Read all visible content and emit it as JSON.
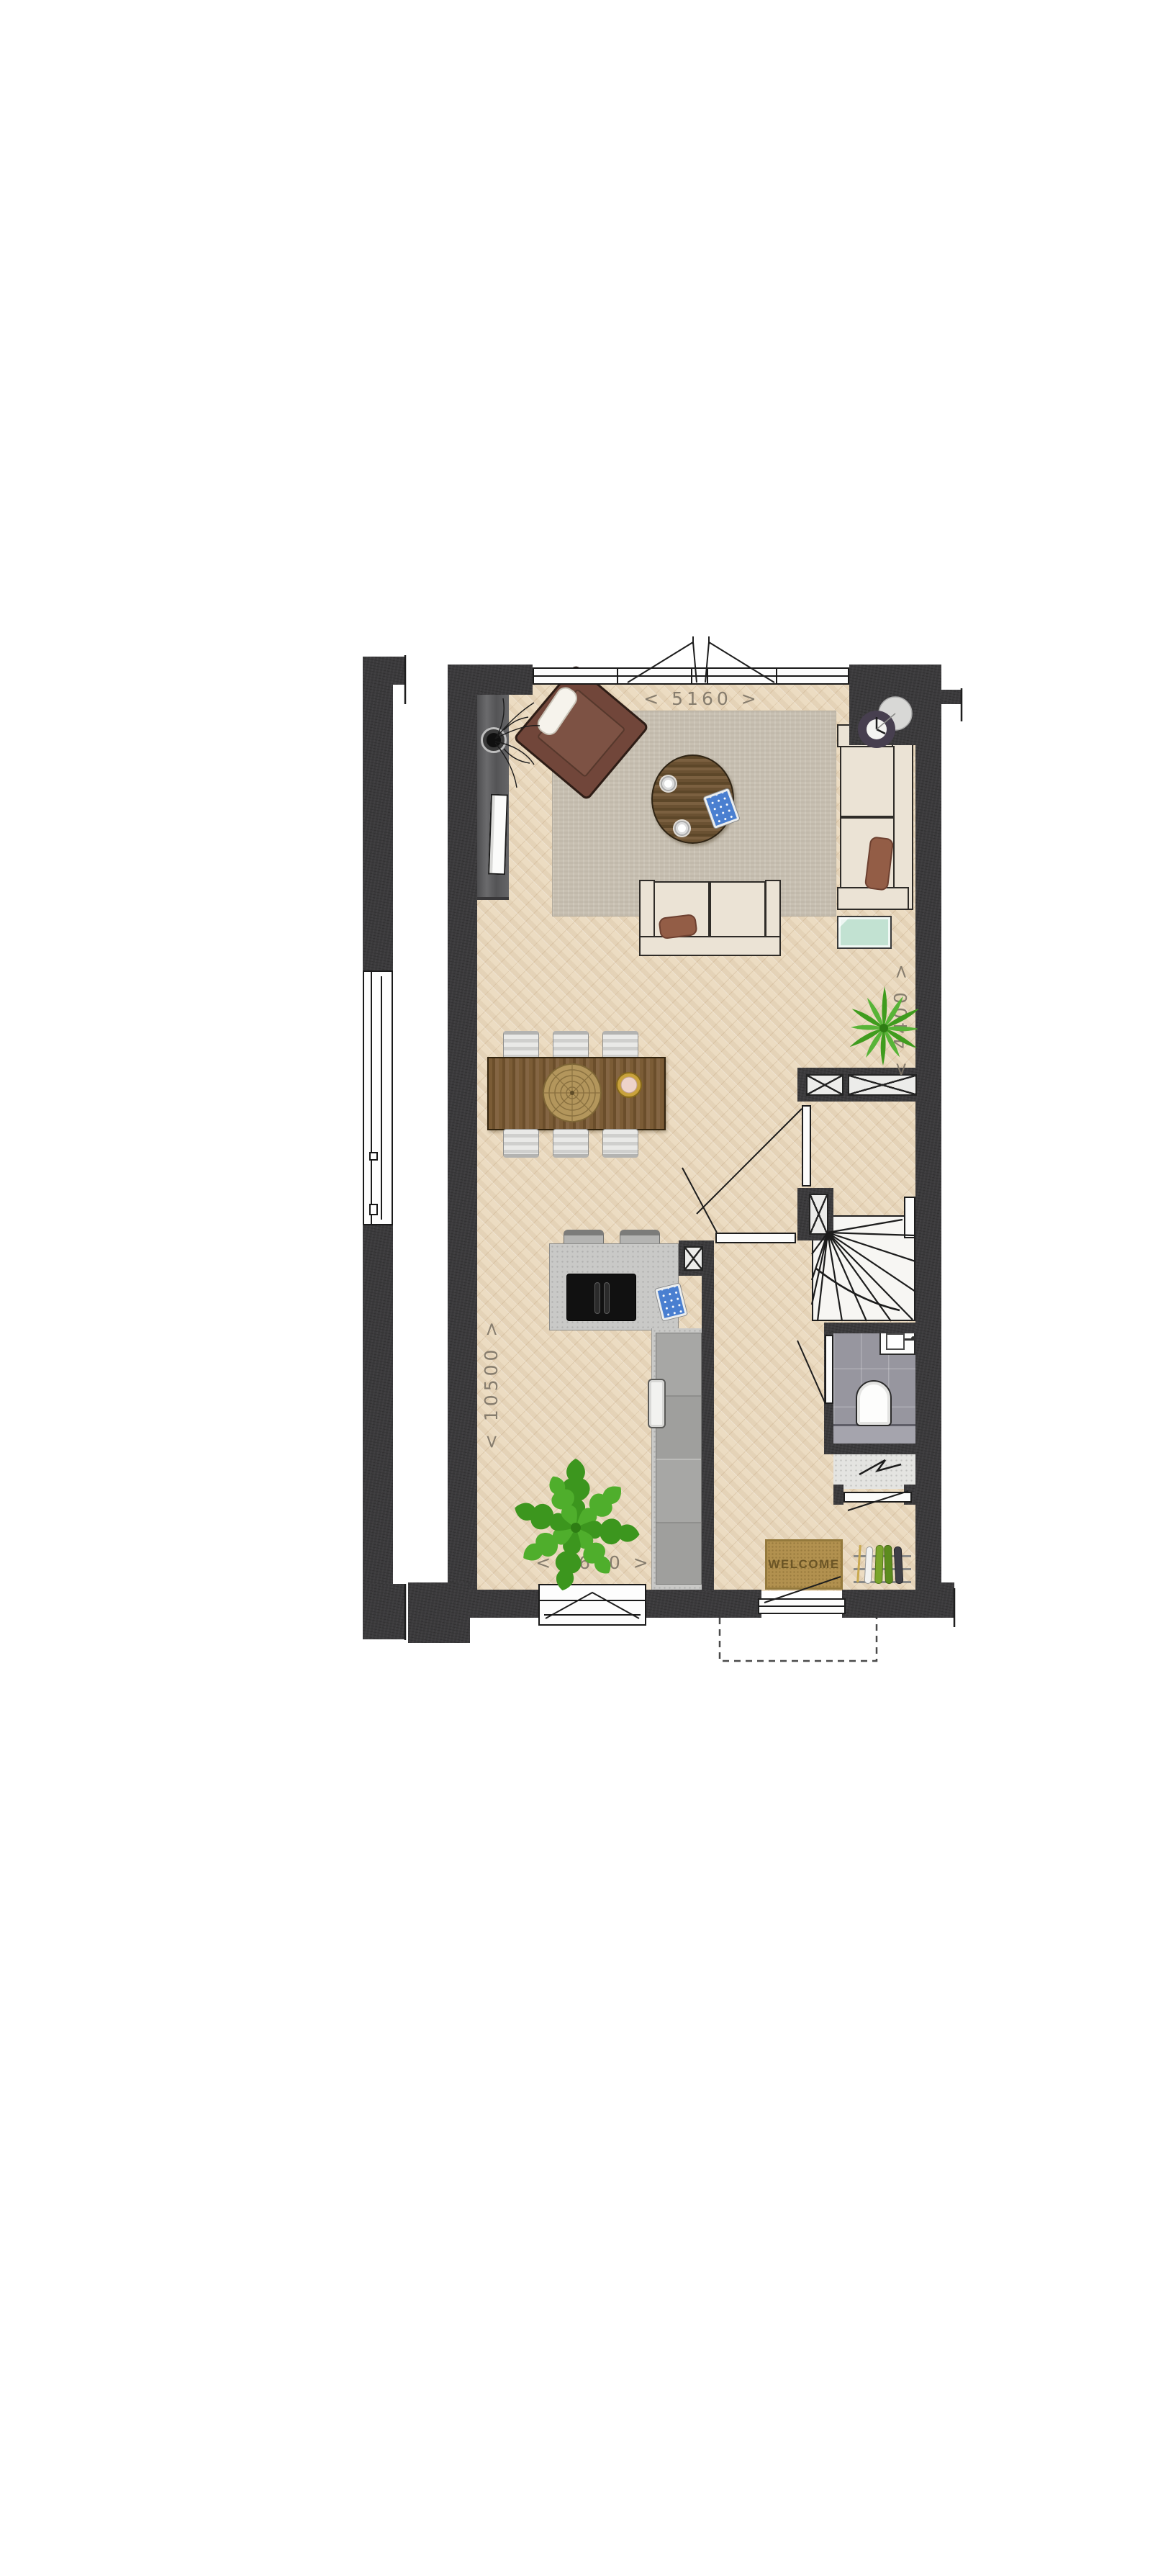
{
  "plan": {
    "type": "residential-ground-floor-plan",
    "dimension_labels": {
      "top_width": "< 5160 >",
      "right_depth": "< 4400 >",
      "left_depth": "< 10500 >",
      "bottom_kitchen_width": "< 2660 >"
    },
    "doormat": {
      "label": "WELCOME"
    },
    "colors": {
      "wall": "#3b3a3c",
      "floor_wood": "#ecdcc2",
      "rug": "#c8c0b2",
      "sofa_cream": "#ebe3d5",
      "pillow_brown": "#935d46",
      "armchair_brown": "#71463a",
      "table_walnut": "#7a5c36",
      "counter_gray": "#c9c9c7",
      "cabinet_gray": "#a0a09e",
      "toilet_tile_gray": "#97969f",
      "doormat_tan": "#b2914f",
      "plant_green": "#45a323",
      "glass_mint": "#c2e2d2",
      "clock_purple": "#473f4f",
      "line_dark": "#1d1d1d",
      "window_frame": "#fdfdfd"
    }
  }
}
